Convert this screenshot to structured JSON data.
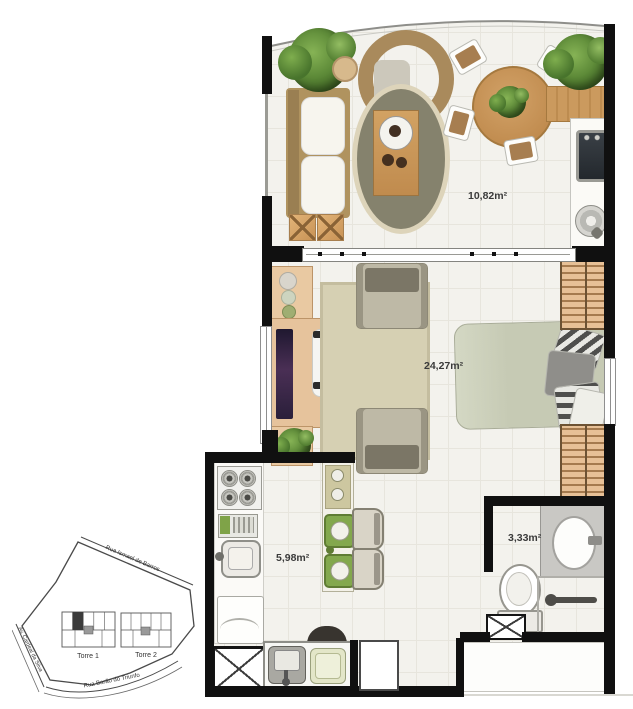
{
  "document": {
    "kind": "apartment floor plan with site key plan"
  },
  "floor_plan": {
    "rooms": [
      {
        "name": "varanda gourmet",
        "area_label": "10,82m²"
      },
      {
        "name": "studio living/bedroom",
        "area_label": "24,27m²"
      },
      {
        "name": "kitchen",
        "area_label": "5,98m²"
      },
      {
        "name": "bathroom",
        "area_label": "3,33m²"
      }
    ]
  },
  "site_plan": {
    "streets": [
      {
        "name": "Rua Ismael de Barros"
      },
      {
        "name": "Av. Cardeal da Silva"
      },
      {
        "name": "Rua Barão do Triunfo"
      }
    ],
    "towers": [
      {
        "label": "Torre 1"
      },
      {
        "label": "Torre 2"
      }
    ],
    "highlighted_tower": "Torre 1"
  },
  "colors": {
    "wall": "#101010",
    "floor": "#f3f2ed",
    "wood_light": "#e6c39c",
    "wood_medium": "#c8955a",
    "sage_bed": "#c6cab4",
    "olive_rug": "#85826d",
    "green_seat": "#83a84d",
    "plant_green": "#5d8a38",
    "vanity_gray": "#c9c8c4"
  }
}
